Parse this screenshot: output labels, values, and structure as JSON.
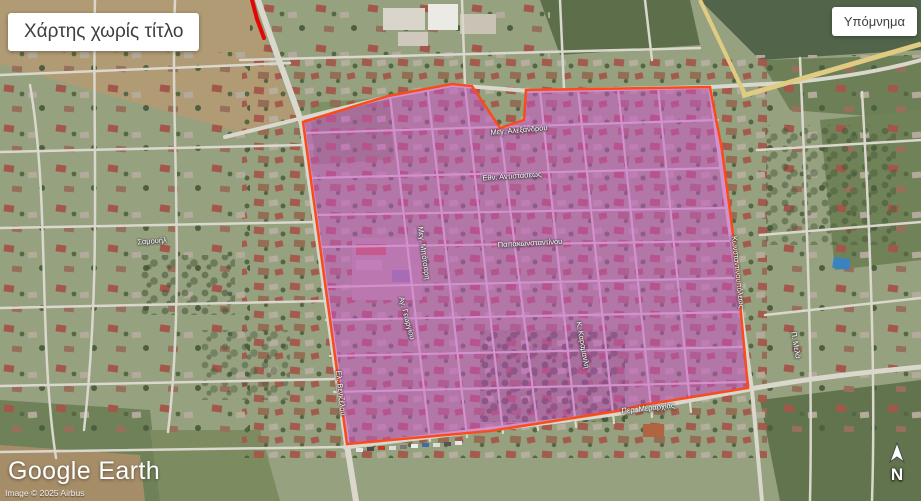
{
  "chrome": {
    "map_title": "Χάρτης χωρίς τίτλο",
    "legend_label": "Υπόμνημα",
    "logo_text": "Google Earth",
    "copyright": "Image © 2025 Airbus",
    "compass_label": "N"
  },
  "annotations": {
    "highlight_polygon": {
      "fill": "#cb4ecb",
      "fill_opacity": 0.52,
      "stroke": "#fa4b1b",
      "stroke_width": 2.5,
      "points": [
        [
          303,
          122
        ],
        [
          388,
          96
        ],
        [
          452,
          84
        ],
        [
          472,
          86
        ],
        [
          500,
          128
        ],
        [
          524,
          120
        ],
        [
          526,
          90
        ],
        [
          710,
          87
        ],
        [
          722,
          150
        ],
        [
          735,
          250
        ],
        [
          748,
          388
        ],
        [
          643,
          405
        ],
        [
          618,
          411
        ],
        [
          490,
          431
        ],
        [
          347,
          444
        ]
      ]
    },
    "red_line": {
      "stroke": "#e60505",
      "stroke_width": 4,
      "points": [
        [
          252,
          0
        ],
        [
          257,
          19
        ],
        [
          264,
          38
        ]
      ]
    }
  },
  "street_labels": [
    {
      "text": "Σαμουήλ",
      "x": 152,
      "y": 241,
      "rotate": -4
    },
    {
      "text": "Μεγ. Αλεξάνδρου",
      "x": 519,
      "y": 130,
      "rotate": -5
    },
    {
      "text": "Εθν. Αντιστάσεως",
      "x": 512,
      "y": 176,
      "rotate": -4
    },
    {
      "text": "Παπακωνσταντίνου",
      "x": 530,
      "y": 243,
      "rotate": -3
    },
    {
      "text": "Μεγ. Μπότσαρη",
      "x": 424,
      "y": 253,
      "rotate": 82
    },
    {
      "text": "Αγ. Γεωργίου",
      "x": 407,
      "y": 318,
      "rotate": 75
    },
    {
      "text": "Κ. Καραμανλή",
      "x": 583,
      "y": 345,
      "rotate": 80
    },
    {
      "text": "Περ. Μεραρχίας",
      "x": 648,
      "y": 408,
      "rotate": -6
    },
    {
      "text": "Κωνσταντινουπόλεως",
      "x": 738,
      "y": 272,
      "rotate": 84
    },
    {
      "text": "Ελ. Βενιζέλου",
      "x": 341,
      "y": 393,
      "rotate": 84
    },
    {
      "text": "Π. Μελά",
      "x": 796,
      "y": 345,
      "rotate": 80
    }
  ]
}
